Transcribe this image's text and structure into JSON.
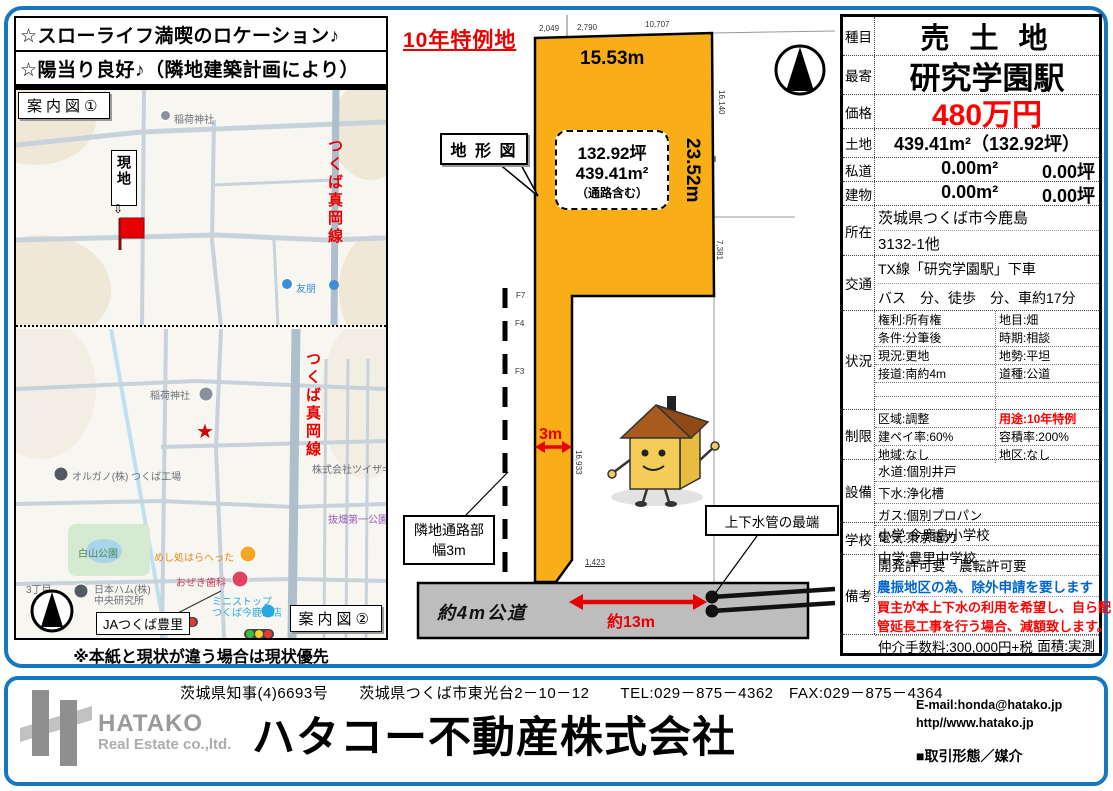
{
  "colors": {
    "frame_blue": "#1778C2",
    "plot_orange": "#F9AE17",
    "road_gray": "#BDBDBD",
    "alert_red": "#FF0000",
    "note_blue": "#0066CC"
  },
  "catch": {
    "line1": "☆スローライフ満喫のロケーション♪",
    "line2": "☆陽当り良好♪（隣地建築計画により）"
  },
  "maps": {
    "label1": "案内図①",
    "label2": "案内図②",
    "disclaimer": "※本紙と現状が違う場合は現状優先",
    "site_label": "現地",
    "route_name": "つくば真岡線",
    "shrine": "稲荷神社",
    "poi_yuho": "友朋",
    "organo": "オルガノ(株) つくば工場",
    "park": "白山公園",
    "nipponham1": "日本ハム(株)",
    "nipponham2": "中央研究所",
    "restaurant": "めし処はらへった",
    "dental": "おぜき歯科",
    "tsuizaki": "株式会社ツイザキ",
    "nukihata": "抜畑第一公園",
    "chome": "3丁目",
    "ministop1": "ミニストップ",
    "ministop2": "つくば今鹿島店",
    "ja_callout": "JAつくば豊里"
  },
  "diagram": {
    "special_label": "10年特例地",
    "title": "地 形 図",
    "width_label": "15.53m",
    "height_label": "23.52m",
    "area_tsubo": "132.92坪",
    "area_sqm": "439.41m²",
    "area_note": "（通路含む）",
    "dim_top_a": "2,049",
    "dim_top_b": "2,790",
    "dim_top_c": "10,707",
    "dim_right_a": "16,140",
    "dim_right_b": "7,381",
    "dim_corridor": "16,933",
    "dim_chamfer": "1,423",
    "f7": "F7",
    "f4": "F4",
    "f3": "F3",
    "corridor_width": "3m",
    "neighbor1": "隣地通路部",
    "neighbor2": "幅3m",
    "road_label": "約4m公道",
    "distance_label": "約13m",
    "pipe_label": "上下水管の最端"
  },
  "spec": {
    "shumoku_label": "種目",
    "shumoku": "売 土 地",
    "moyori_label": "最寄",
    "moyori": "研究学園駅",
    "kakaku_label": "価格",
    "kakaku": "480万円",
    "tochi_label": "土地",
    "tochi": "439.41m²（132.92坪）",
    "shido_label": "私道",
    "shido_m2": "0.00m²",
    "shido_tsubo": "0.00坪",
    "tatemono_label": "建物",
    "tatemono_m2": "0.00m²",
    "tatemono_tsubo": "0.00坪",
    "shozai_label": "所在",
    "shozai1": "茨城県つくば市今鹿島",
    "shozai2": "3132-1他",
    "kotsu_label": "交通",
    "kotsu1": "TX線「研究学園駅」下車",
    "kotsu2": "バス　分、徒歩　分、車約17分",
    "jokyo_label": "状況",
    "jokyo": [
      [
        "権利:所有権",
        "地目:畑"
      ],
      [
        "条件:分筆後",
        "時期:相談"
      ],
      [
        "現況:更地",
        "地勢:平坦"
      ],
      [
        "接道:南約4m",
        "道種:公道"
      ]
    ],
    "seigen_label": "制限",
    "seigen": [
      [
        "区域:調整",
        "用途:10年特例"
      ],
      [
        "建ペイ率:60%",
        "容積率:200%"
      ],
      [
        "地域:なし",
        "地区:なし"
      ]
    ],
    "setsubi_label": "設備",
    "setsubi": [
      "水道:個別井戸",
      "下水:浄化槽",
      "ガス:個別プロパン",
      "電気:東京電力"
    ],
    "gakko_label": "学校",
    "gakko": [
      "小学:今鹿島小学校",
      "中学:豊里中学校"
    ],
    "biko_label": "備考",
    "biko1": "開発許可要　農転許可要",
    "biko2": "農振地区の為、除外申請を要します",
    "biko3": "買主が本上下水の利用を希望し、自ら配",
    "biko4": "管延長工事を行う場合、減額致します。",
    "biko5": "仲介手数料:300,000円+税",
    "menseki": "面積:実測"
  },
  "footer": {
    "license": "茨城県知事(4)6693号　　茨城県つくば市東光台2－10－12　　TEL:029－875－4362　FAX:029－875－4364",
    "company": "ハタコー不動産株式会社",
    "logo_main": "HATAKO",
    "logo_sub": "Real Estate co.,ltd.",
    "email": "E-mail:honda@hatako.jp",
    "web": "http//www.hatako.jp",
    "deal": "■取引形態／媒介"
  }
}
